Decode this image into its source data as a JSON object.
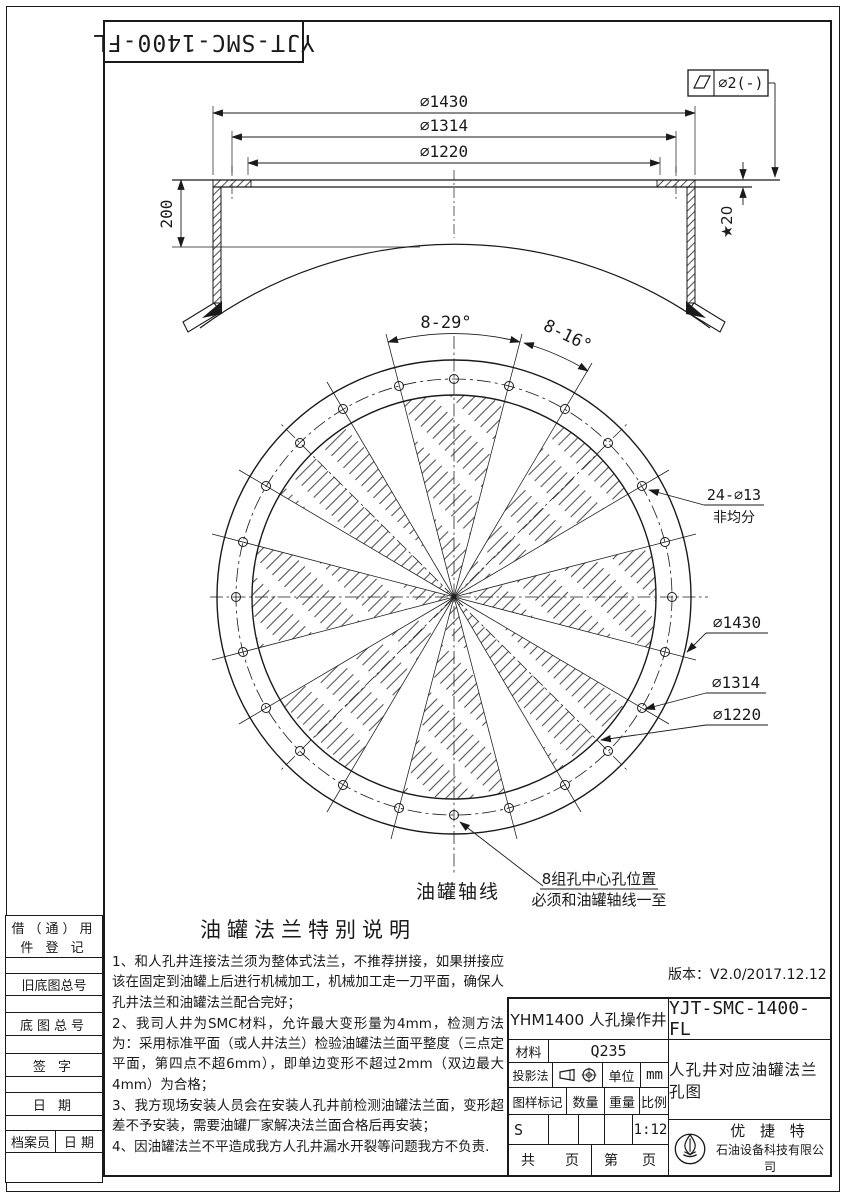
{
  "colors": {
    "line": "#1a1a1a",
    "background": "#ffffff"
  },
  "corner_code": "YJT-SMC-1400-FL",
  "version_note": "版本：V2.0/2017.12.12",
  "gdt": {
    "tolerance_value": "∅2(-)"
  },
  "side_view": {
    "dia_outer": "∅1430",
    "dia_bolt": "∅1314",
    "dia_inner": "∅1220",
    "neck_height": "200",
    "plate_thickness": "★20"
  },
  "plan_view": {
    "angle_sector": "8-29°",
    "angle_gap": "8-16°",
    "holes_count": "24-∅13",
    "holes_note": "非均分",
    "dia_outer": "∅1430",
    "dia_bolt": "∅1314",
    "dia_inner": "∅1220",
    "axis_label": "油罐轴线",
    "hole_note_line1": "8组孔中心孔位置",
    "hole_note_line2": "必须和油罐轴线一至"
  },
  "notes": {
    "title": "油罐法兰特别说明",
    "items": [
      "1、和人孔井连接法兰须为整体式法兰，不推荐拼接，如果拼接应该在固定到油罐上后进行机械加工，机械加工走一刀平面，确保人孔井法兰和油罐法兰配合完好；",
      "2、我司人井为SMC材料，允许最大变形量为4mm，检测方法为：采用标准平面（或人井法兰）检验油罐法兰面平整度（三点定平面，第四点不超6mm），即单边变形不超过2mm（双边最大4mm）为合格；",
      "3、我方现场安装人员会在安装人孔井前检测油罐法兰面，变形超差不予安装，需要油罐厂家解决法兰面合格后再安装；",
      "4、因油罐法兰不平造成我方人孔井漏水开裂等问题我方不负责."
    ]
  },
  "left_table": {
    "reuse_line1": "借（通）用",
    "reuse_line2": "件 登 记",
    "old_base_no": "旧底图总号",
    "base_no": "底图总号",
    "signature": "签 字",
    "date": "日 期",
    "archivist": "档案员",
    "archive_date": "日 期"
  },
  "title_block": {
    "model": "YHM1400  人孔操作井",
    "code": "YJT-SMC-1400-FL",
    "material_label": "材料",
    "material_value": "Q235",
    "projection_label": "投影法",
    "unit_label": "单位",
    "unit_value": "mm",
    "mark_label": "图样标记",
    "qty_label": "数量",
    "weight_label": "重量",
    "scale_label": "比例",
    "mark_value": "S",
    "scale_value": "1:12",
    "drawing_title": "人孔井对应油罐法兰孔图",
    "sheet_total_label": "共",
    "sheet_total_unit": "页",
    "sheet_no_label": "第",
    "sheet_no_unit": "页",
    "company_name": "优 捷 特",
    "company_sub": "石油设备科技有限公司"
  }
}
